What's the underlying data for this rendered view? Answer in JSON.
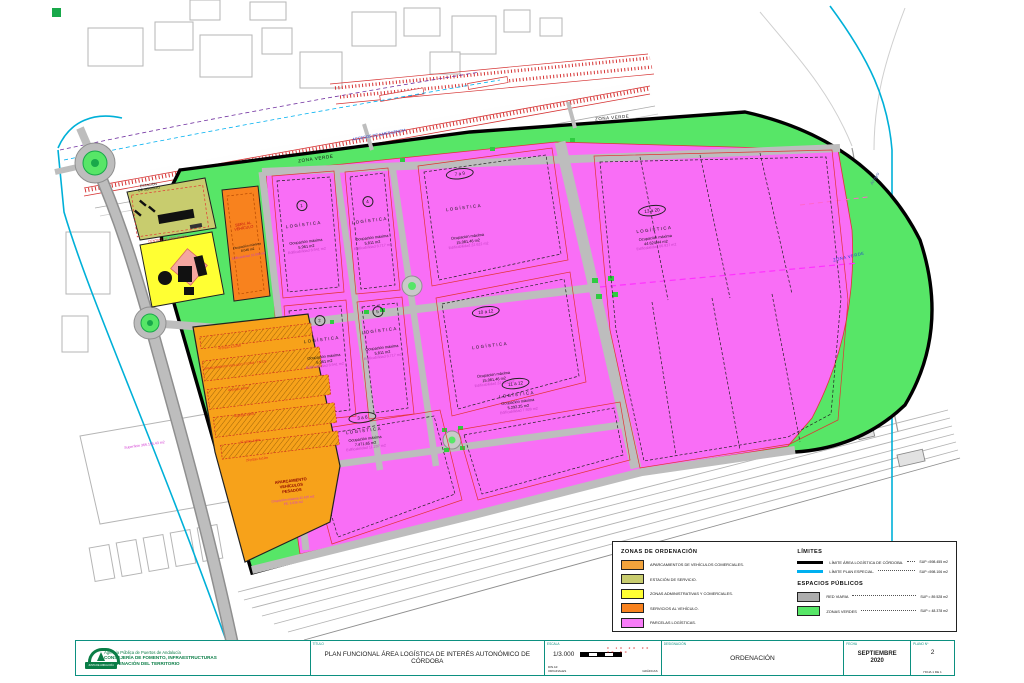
{
  "map": {
    "green_labels": {
      "top1": "ZONA VERDE",
      "top2": "ZONA VERDE",
      "right": "ZONA VERDE"
    },
    "notes": {
      "accesos": "ACCESOS DE EMERGENCIA",
      "arroyo": "Arroyo",
      "superficie": "Superficie 366.155,43 m2"
    },
    "estacion": {
      "l1": "ESTACIÓN",
      "l2": "DE SERVICIO"
    },
    "centro": {
      "l1": "CENTRO DE SERVICIOS"
    },
    "serv_vehiculo": {
      "t1": "SERV. AL",
      "t2": "VEHÍCULO",
      "l1": "Ocupación máxima",
      "l2": "8.046 m2",
      "l3": "Edificabilidad 10.000 m2"
    },
    "parking": {
      "rows": [
        "42 plzas 4,5x5m",
        "APARCAMIENTO VIGILADO TT.CAM - T.N.CH.",
        "40 plzas 4x9m",
        "40 plzas 4x9m",
        "37 plzas 4x9m",
        "29 plzas 4x12m"
      ],
      "t1": "APARCAMIENTO",
      "t2": "VEHÍCULOS",
      "t3": "PESADOS",
      "s1": "Ocupación máxima 32.425 m2",
      "s2": "PE: 5.936 m2"
    },
    "parcels": [
      {
        "badge": "1",
        "name": "LOGÍSTICA",
        "l1": "Ocupación máxima",
        "l2": "5.961 m2",
        "l3": "Edificabilidad 8.941 m2"
      },
      {
        "badge": "4",
        "name": "LOGÍSTICA",
        "l1": "Ocupación máxima",
        "l2": "5.811 m2",
        "l3": "Edificabilidad 8.717 m2"
      },
      {
        "badge": "7 a 9",
        "name": "LOGÍSTICA",
        "l1": "Ocupación máxima",
        "l2": "15.081,46 m2",
        "l3": "Edificabilidad 22.622 m2"
      },
      {
        "badge": "13 a 20",
        "name": "LOGÍSTICA",
        "l1": "Ocupación máxima",
        "l2": "44.624,44 m2",
        "l3": "Edificabilidad 66.937 m2"
      },
      {
        "badge": "2",
        "name": "LOGÍSTICA",
        "l1": "Ocupación máxima",
        "l2": "5.961 m2",
        "l3": "Edificabilidad 8.941 m2"
      },
      {
        "badge": "5",
        "name": "LOGÍSTICA",
        "l1": "Ocupación máxima",
        "l2": "5.811 m2",
        "l3": "Edificabilidad 8.717 m2"
      },
      {
        "badge": "10 a 12",
        "name": "LOGÍSTICA",
        "l1": "Ocupación máxima",
        "l2": "15.081,46 m2",
        "l3": "Edificabilidad 22.622 m2"
      },
      {
        "badge": "3 a 6",
        "name": "LOGÍSTICA",
        "l1": "Ocupación máxima",
        "l2": "7.471,65 m2",
        "l3": "Edificabilidad 11.207 m2"
      },
      {
        "badge": "11 a 12",
        "name": "LOGÍSTICA",
        "l1": "Ocupación máxima",
        "l2": "5.292,25 m2",
        "l3": "Edificabilidad 7.938 m2"
      }
    ]
  },
  "legend": {
    "zonas": {
      "title": "ZONAS DE ORDENACIÓN",
      "items": [
        {
          "color": "#F2A33C",
          "label": "APARCAMIENTOS DE VEHÍCULOS COMERCIALES."
        },
        {
          "color": "#C8CC6E",
          "label": "ESTACIÓN DE SERVICIO."
        },
        {
          "color": "#FFFF33",
          "label": "ZONAS ADMINISTRATIVAS Y COMERCIALES."
        },
        {
          "color": "#F8821E",
          "label": "SERVICIOS AL VEHÍCULO."
        },
        {
          "color": "#F87CF8",
          "label": "PARCELAS LOGÍSTICAS."
        }
      ]
    },
    "limites": {
      "title": "LÍMITES",
      "items": [
        {
          "color": "#000000",
          "label": "LÍMITE ÁREA LOGÍSTICA DE CÓRDOBA.",
          "sup": "SUP =598.455 m2"
        },
        {
          "color": "#00B0F0",
          "label": "LÍMITE PLAN ESPECIAL.",
          "sup": "SUP =598.106 m2"
        }
      ]
    },
    "espacios": {
      "title": "ESPACIOS PÚBLICOS",
      "items": [
        {
          "color": "#ADADAD",
          "label": "RED VIARIA",
          "sup": "SUP = 89.528 m2"
        },
        {
          "color": "#57E667",
          "label": "ZONAS VERDES",
          "sup": "SUP = 48.378 m2"
        }
      ]
    }
  },
  "titleblock": {
    "agency": {
      "logo": "JUNTA DE ANDALUCÍA",
      "line1": "Agencia Pública de Puertos de Andalucía",
      "line2": "CONSEJERÍA DE FOMENTO, INFRAESTRUCTURAS",
      "line3": "Y ORDENACIÓN DEL TERRITORIO"
    },
    "titulo_label": "TÍTULO",
    "titulo": "PLAN FUNCIONAL ÁREA LOGÍSTICA DE INTERÉS AUTONÓMICO DE CÓRDOBA",
    "escala_label": "ESCALA",
    "escala": "1/3.000",
    "escala_nums": "0 10 20 30 40 50",
    "escala_din1": "DIN A3",
    "escala_din2": "ORIGINALES",
    "escala_graf": "GRÁFICAS",
    "designacion_label": "DESIGNACIÓN",
    "designacion": "ORDENACIÓN",
    "fecha_label": "FECHA",
    "fecha1": "SEPTIEMBRE",
    "fecha2": "2020",
    "plano_label": "PLANO Nº",
    "plano": "2",
    "hoja": "HOJA  1  DE  1"
  },
  "colors": {
    "zona_verde": "#57E667",
    "parcela_logistica": "#F96EF6",
    "red_viaria": "#BDBDBD",
    "limite_area": "#000000",
    "limite_plan_especial": "#00B0F0",
    "marco": "#0C9080"
  }
}
